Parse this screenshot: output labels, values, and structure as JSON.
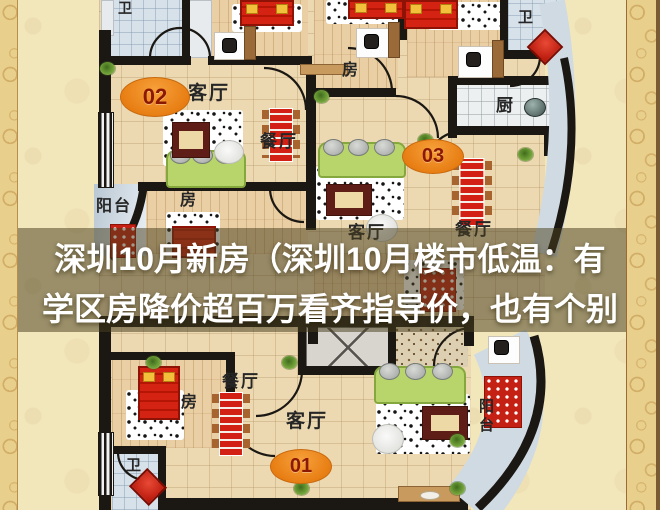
{
  "overlay": {
    "line1": "深圳10月新房（深圳10月楼市低温：有",
    "line2": "学区房降价超百万看齐指导价，也有个别"
  },
  "units": {
    "u01": "01",
    "u02": "02",
    "u03": "03"
  },
  "labels": {
    "living": "客厅",
    "dining": "餐厅",
    "room": "房",
    "balcony": "阳台",
    "bath": "卫",
    "kitchen": "厨"
  },
  "colors": {
    "background_cream": "#f2e6bb",
    "gold_border": "#e9cf8c",
    "wall_black": "#1b1713",
    "unit_ellipse_orange": "#e77d12",
    "unit_number_red": "#8b1800",
    "bed_red": "#d42312",
    "sofa_green": "#b7d56b",
    "bath_blue": "#d6e1ea",
    "overlay_band": "rgba(72,64,30,0.52)",
    "overlay_text": "#ffffff"
  }
}
